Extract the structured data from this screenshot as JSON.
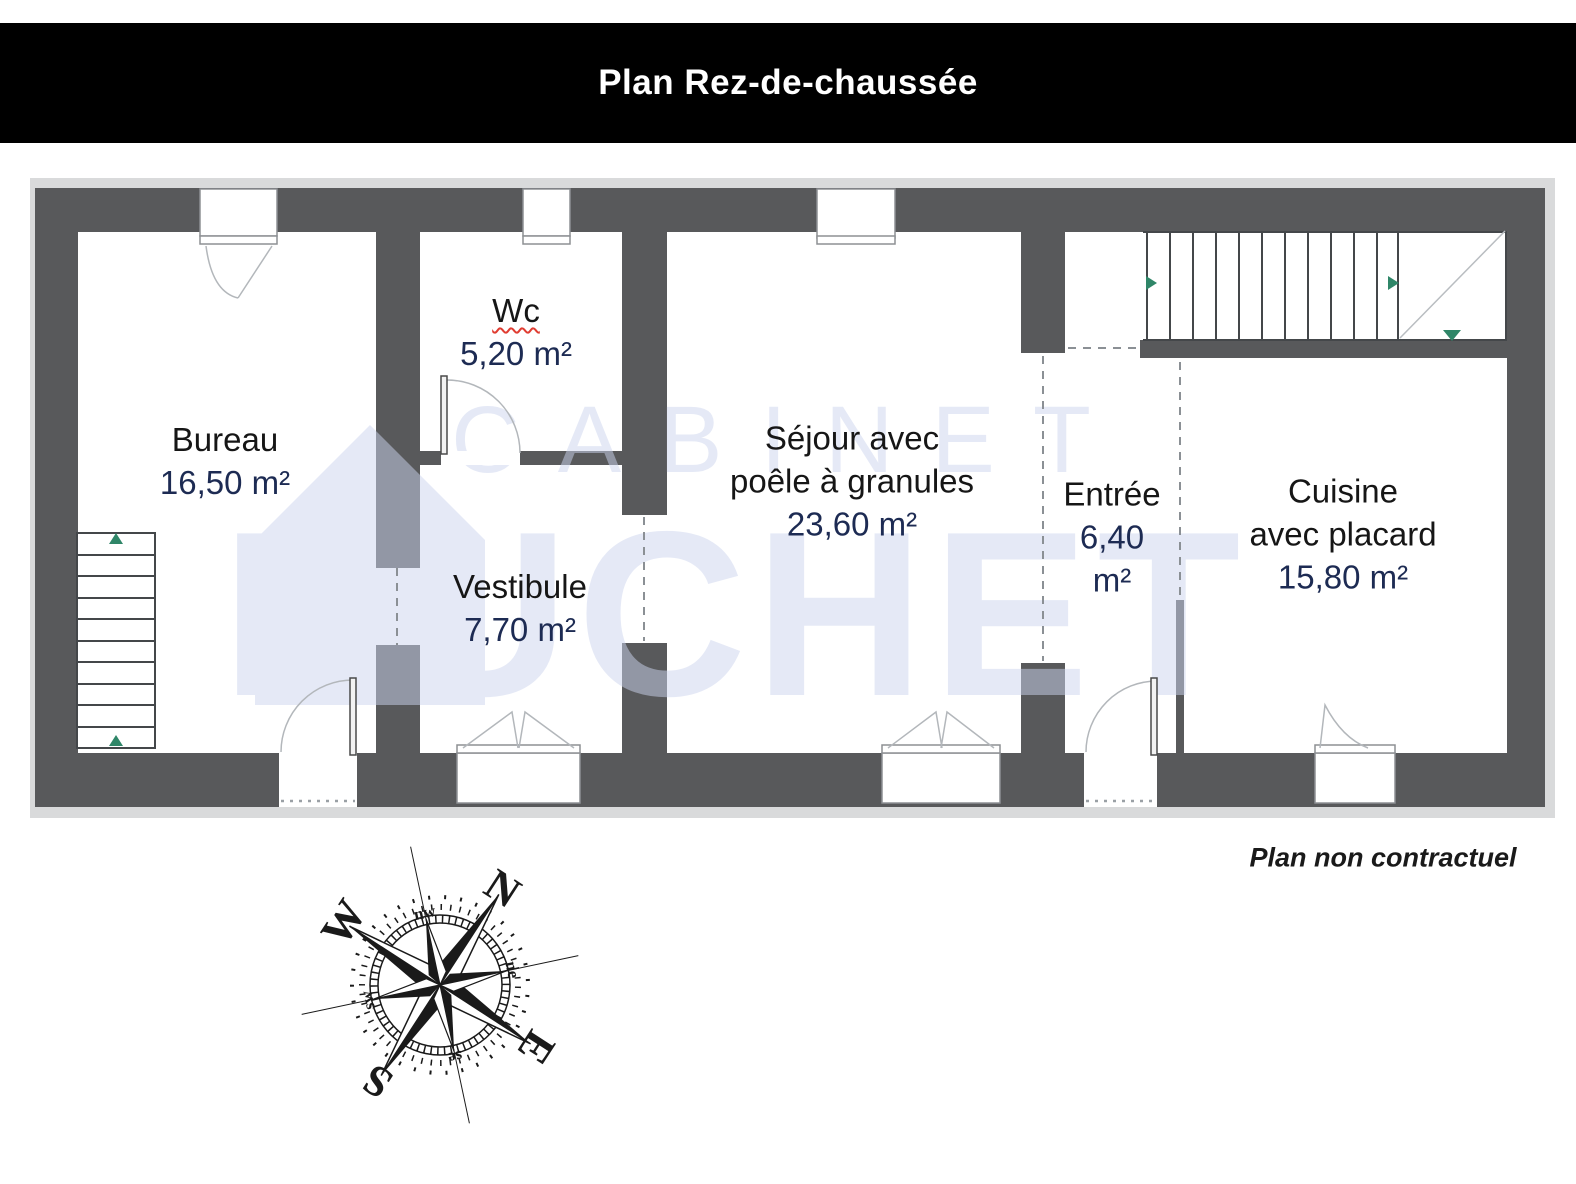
{
  "title": "Plan Rez-de-chaussée",
  "disclaimer": "Plan non contractuel",
  "watermark": {
    "line1": "CABINET",
    "line2": "HUCHET"
  },
  "rooms": [
    {
      "id": "bureau",
      "name_lines": [
        "Bureau"
      ],
      "area_lines": [
        "16,50 m²"
      ]
    },
    {
      "id": "wc",
      "name_lines": [
        "Wc"
      ],
      "area_lines": [
        "5,20 m²"
      ]
    },
    {
      "id": "vestibule",
      "name_lines": [
        "Vestibule"
      ],
      "area_lines": [
        "7,70 m²"
      ]
    },
    {
      "id": "sejour",
      "name_lines": [
        "Séjour avec",
        "poêle à granules"
      ],
      "area_lines": [
        "23,60 m²"
      ]
    },
    {
      "id": "entree",
      "name_lines": [
        "Entrée"
      ],
      "area_lines": [
        "6,40",
        "m²"
      ]
    },
    {
      "id": "cuisine",
      "name_lines": [
        "Cuisine",
        "avec placard"
      ],
      "area_lines": [
        "15,80 m²"
      ]
    }
  ],
  "compass": {
    "cardinals": [
      "N",
      "E",
      "S",
      "W"
    ],
    "intercardinals": [
      "nw",
      "ne",
      "se",
      "sw"
    ]
  },
  "colors": {
    "wall": "#58595b",
    "frame": "#d9dadb",
    "floor": "#ffffff",
    "name_text": "#161616",
    "area_text": "#1d2b53",
    "watermark": "#cdd5ee",
    "stair_arrow": "#2f8668",
    "wc_underline": "#e03c31",
    "title_bar": "#000000",
    "title_text": "#ffffff"
  }
}
